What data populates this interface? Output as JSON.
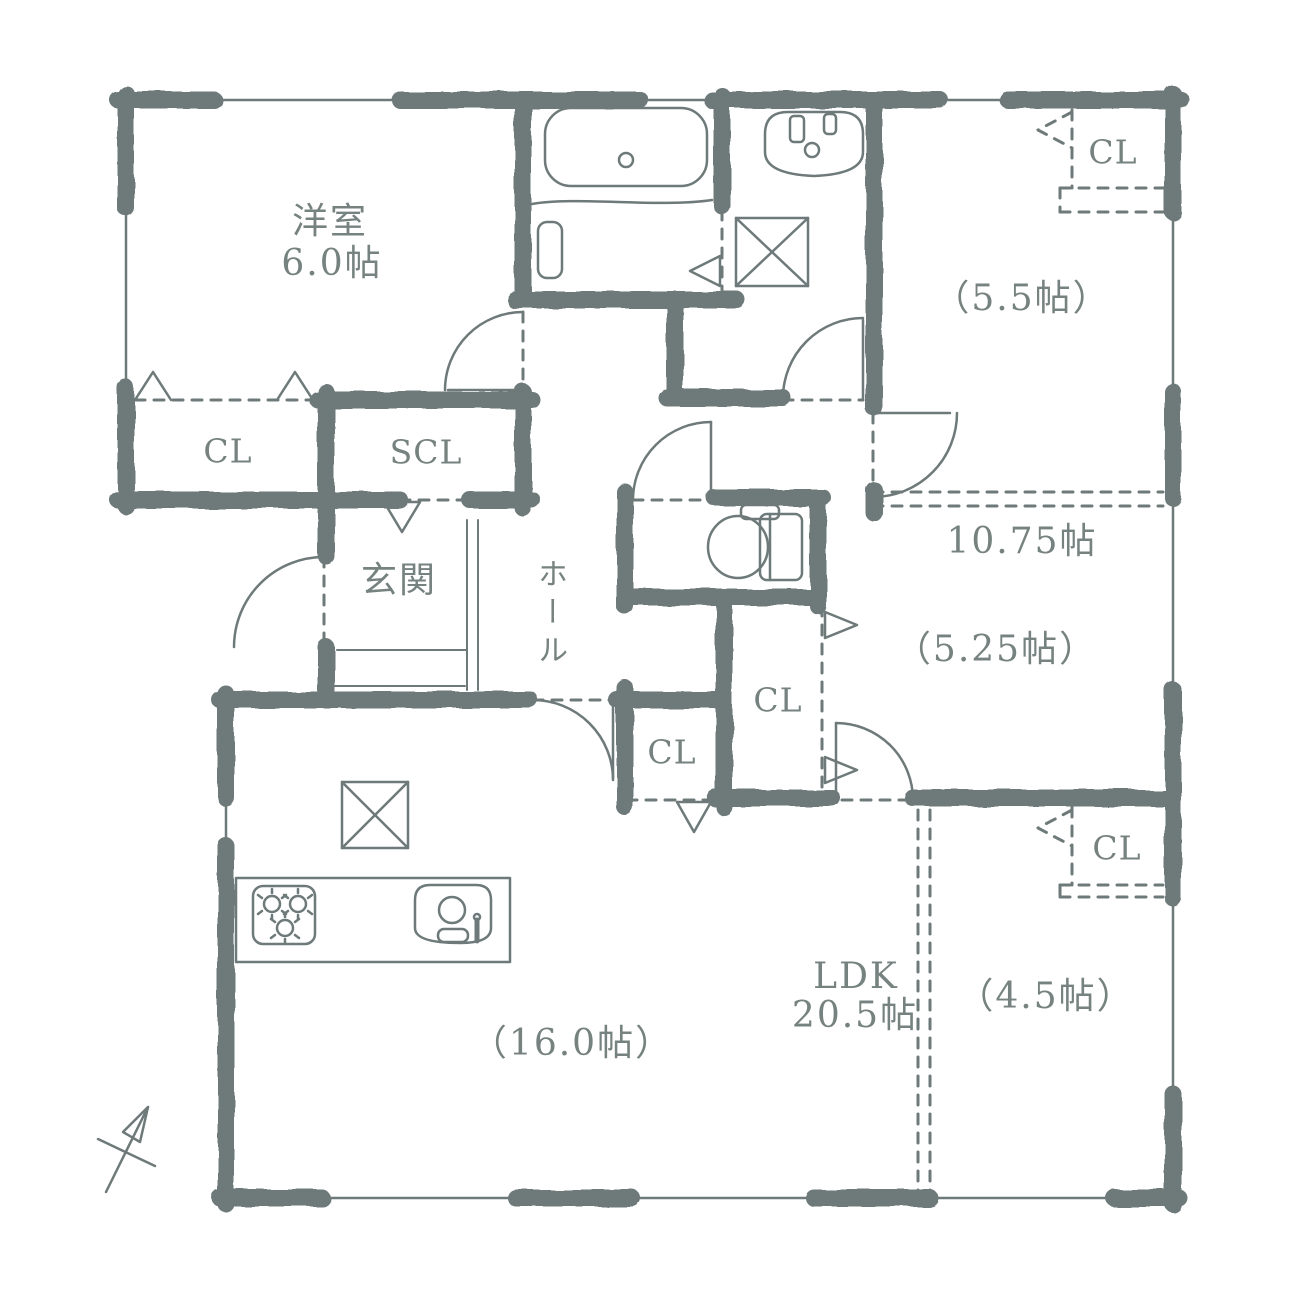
{
  "palette": {
    "ink": "#6e7979",
    "text": "#76827f",
    "bg": "#ffffff"
  },
  "labels": {
    "bedroom_name": "洋室",
    "bedroom_size": "6.0帖",
    "closet": "CL",
    "shoe_closet": "SCL",
    "entrance": "玄関",
    "hall": "ホール",
    "room_5_5": "（5.5帖）",
    "room_10_75": "10.75帖",
    "room_5_25": "（5.25帖）",
    "ldk_name": "LDK",
    "ldk_size": "20.5帖",
    "room_4_5": "（4.5帖）",
    "room_16": "（16.0帖）"
  },
  "icons": {
    "bathtub": "bathtub-icon",
    "washbasin": "washbasin-icon",
    "washer_pan": "washing-machine-pan-icon",
    "toilet": "toilet-icon",
    "stove": "gas-stove-icon",
    "sink": "kitchen-sink-icon",
    "fridge_space": "appliance-space-icon",
    "north_arrow": "north-arrow-icon"
  }
}
